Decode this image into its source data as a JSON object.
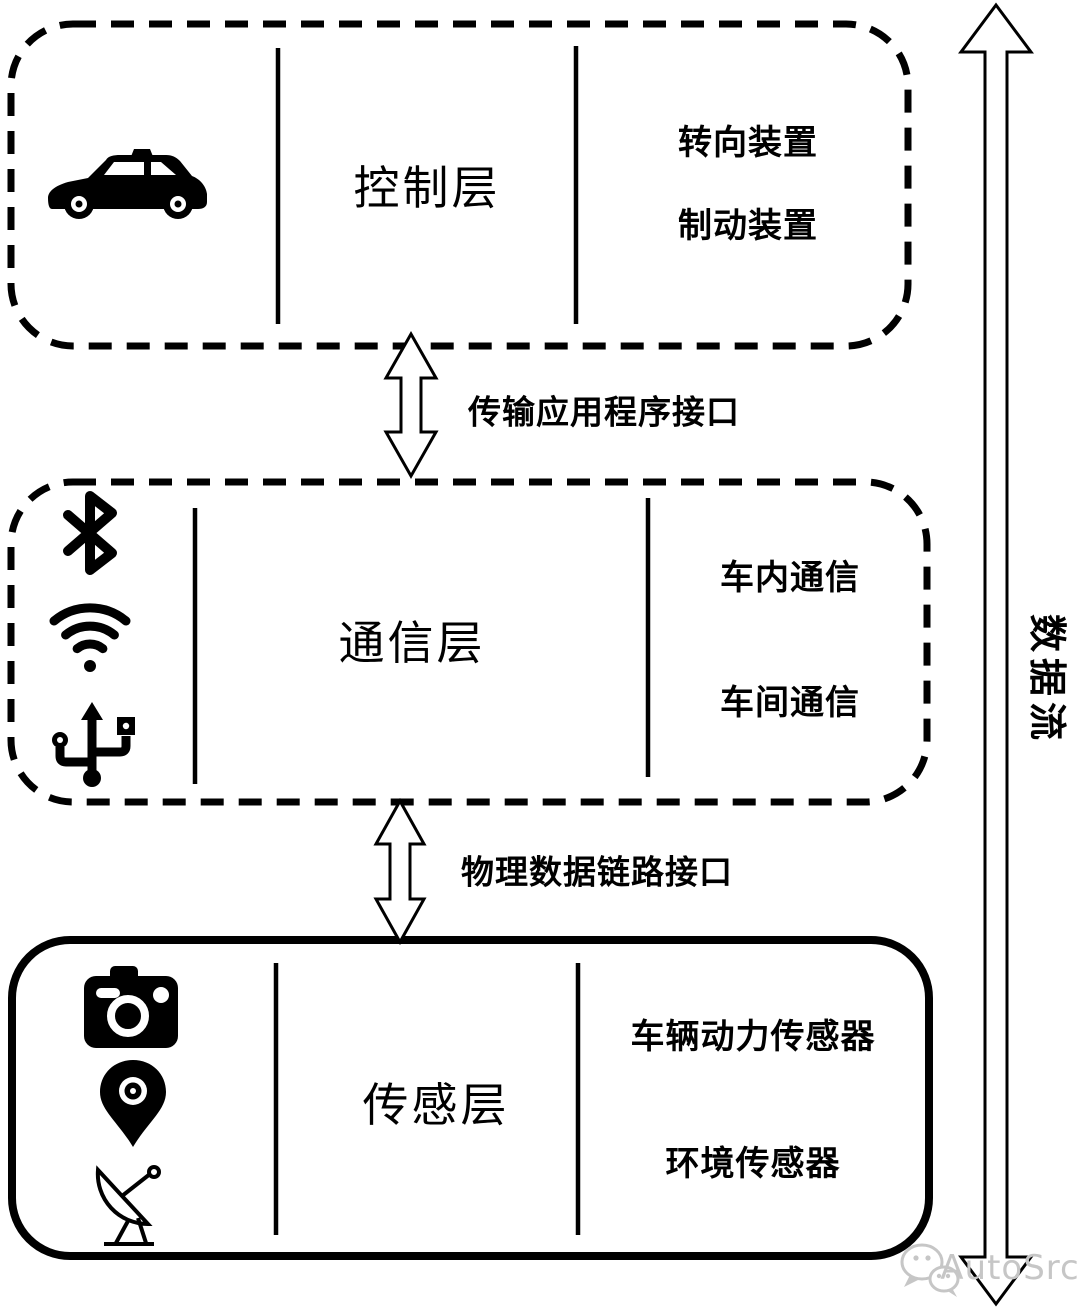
{
  "diagram": {
    "layers": [
      {
        "title": "控制层",
        "items": [
          "转向装置",
          "制动装置"
        ],
        "icons": [
          "car-icon"
        ],
        "border_style": "dashed"
      },
      {
        "title": "通信层",
        "items": [
          "车内通信",
          "车间通信"
        ],
        "icons": [
          "bluetooth-icon",
          "wifi-icon",
          "usb-icon"
        ],
        "border_style": "dashed"
      },
      {
        "title": "传感层",
        "items": [
          "车辆动力传感器",
          "环境传感器"
        ],
        "icons": [
          "camera-icon",
          "location-pin-icon",
          "satellite-dish-icon"
        ],
        "border_style": "solid"
      }
    ],
    "interfaces": [
      {
        "label": "传输应用程序接口"
      },
      {
        "label": "物理数据链路接口"
      }
    ],
    "data_flow_label": "数据流",
    "watermark": "AutoSrc"
  },
  "colors": {
    "foreground": "#000000",
    "background": "#ffffff",
    "watermark": "#c6c6c6"
  }
}
